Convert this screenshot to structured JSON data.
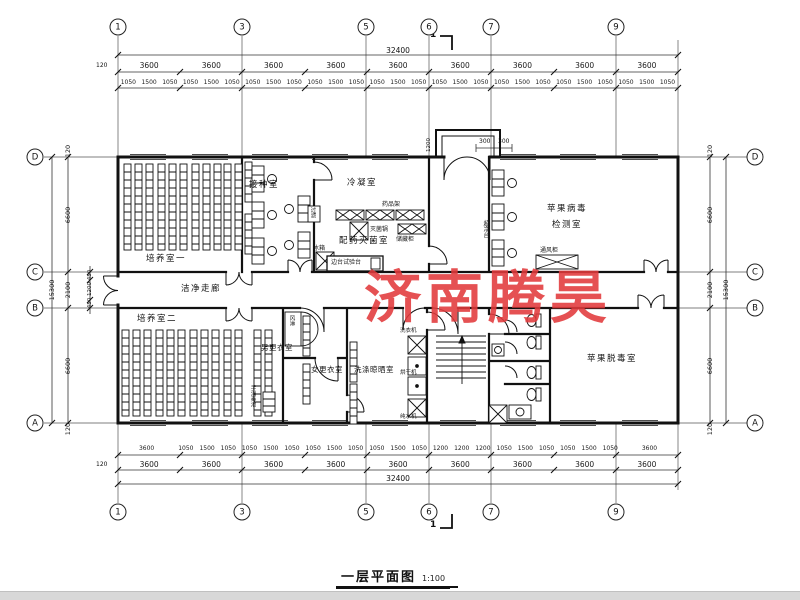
{
  "watermark": {
    "text": "济南腾昊",
    "color": "#e23a3c"
  },
  "titlebar": {
    "title": "一层平面图",
    "scale": "1:100"
  },
  "grid": {
    "cols": [
      "1",
      "3",
      "5",
      "6",
      "7",
      "9"
    ],
    "rows": [
      "D",
      "C",
      "B",
      "A"
    ]
  },
  "dims": {
    "top_total": "32400",
    "bottom_total": "32400",
    "edge_left_top": "120",
    "edge_left_bottom": "120",
    "top_bays": [
      "3600",
      "3600",
      "3600",
      "3600",
      "3600",
      "3600",
      "3600",
      "3600",
      "3600"
    ],
    "top_sub": [
      "1050",
      "1500",
      "1050",
      "1050",
      "1500",
      "1050",
      "1050",
      "1500",
      "1050",
      "1050",
      "1500",
      "1050",
      "1050",
      "1500",
      "1050",
      "1050",
      "1500",
      "1050",
      "1050",
      "1500",
      "1050",
      "1050",
      "1500",
      "1050",
      "1050",
      "1500",
      "1050"
    ],
    "bottom_sub": [
      "3600",
      "1050",
      "1500",
      "1050",
      "1050",
      "1500",
      "1050",
      "1050",
      "1500",
      "1050",
      "1050",
      "1500",
      "1050",
      "1200",
      "1200",
      "1200",
      "1050",
      "1500",
      "1050",
      "1050",
      "1500",
      "1050",
      "3600"
    ],
    "bottom_bays": [
      "3600",
      "3600",
      "3600",
      "3600",
      "3600",
      "3600",
      "3600",
      "3600",
      "3600"
    ],
    "side_total_left": "15300",
    "side_total_right": "15300",
    "left_segs": [
      "120",
      "6600",
      "2100",
      "6600",
      "120"
    ],
    "right_segs": [
      "120",
      "6600",
      "2100",
      "6600",
      "120"
    ],
    "left_inner": [
      "450",
      "1200",
      "450"
    ],
    "entrance_depth": "1200",
    "entrance_splits": [
      "300",
      "300"
    ],
    "section_mark": "1"
  },
  "rooms": {
    "cultivation1": "培养室一",
    "cultivation2": "培养室二",
    "inoculation": "接种室",
    "condensation": "冷凝室",
    "prep_steril": "配药灭菌室",
    "virus_test_line1": "苹果病毒",
    "virus_test_line2": "检测室",
    "detox": "苹果脱毒室",
    "corridor": "洁净走廊",
    "men_changing": "男更衣室",
    "women_changing": "女更衣室",
    "washing": "洗涤晾晒室"
  },
  "equipment": {
    "clean_bench": "超净台",
    "autoclave": "灭菌锅",
    "storage_cabinet": "储藏柜",
    "side_bench": "边台试验台",
    "reagent_rack": "药品架",
    "fridge": "冰箱",
    "pass_box": "过滤",
    "air_shower": "风淋",
    "fume_hood": "通风柜",
    "washer": "洗衣机",
    "dryer": "烘干机",
    "water_purifier": "纯水机",
    "hand_sink": "手消毒池"
  }
}
